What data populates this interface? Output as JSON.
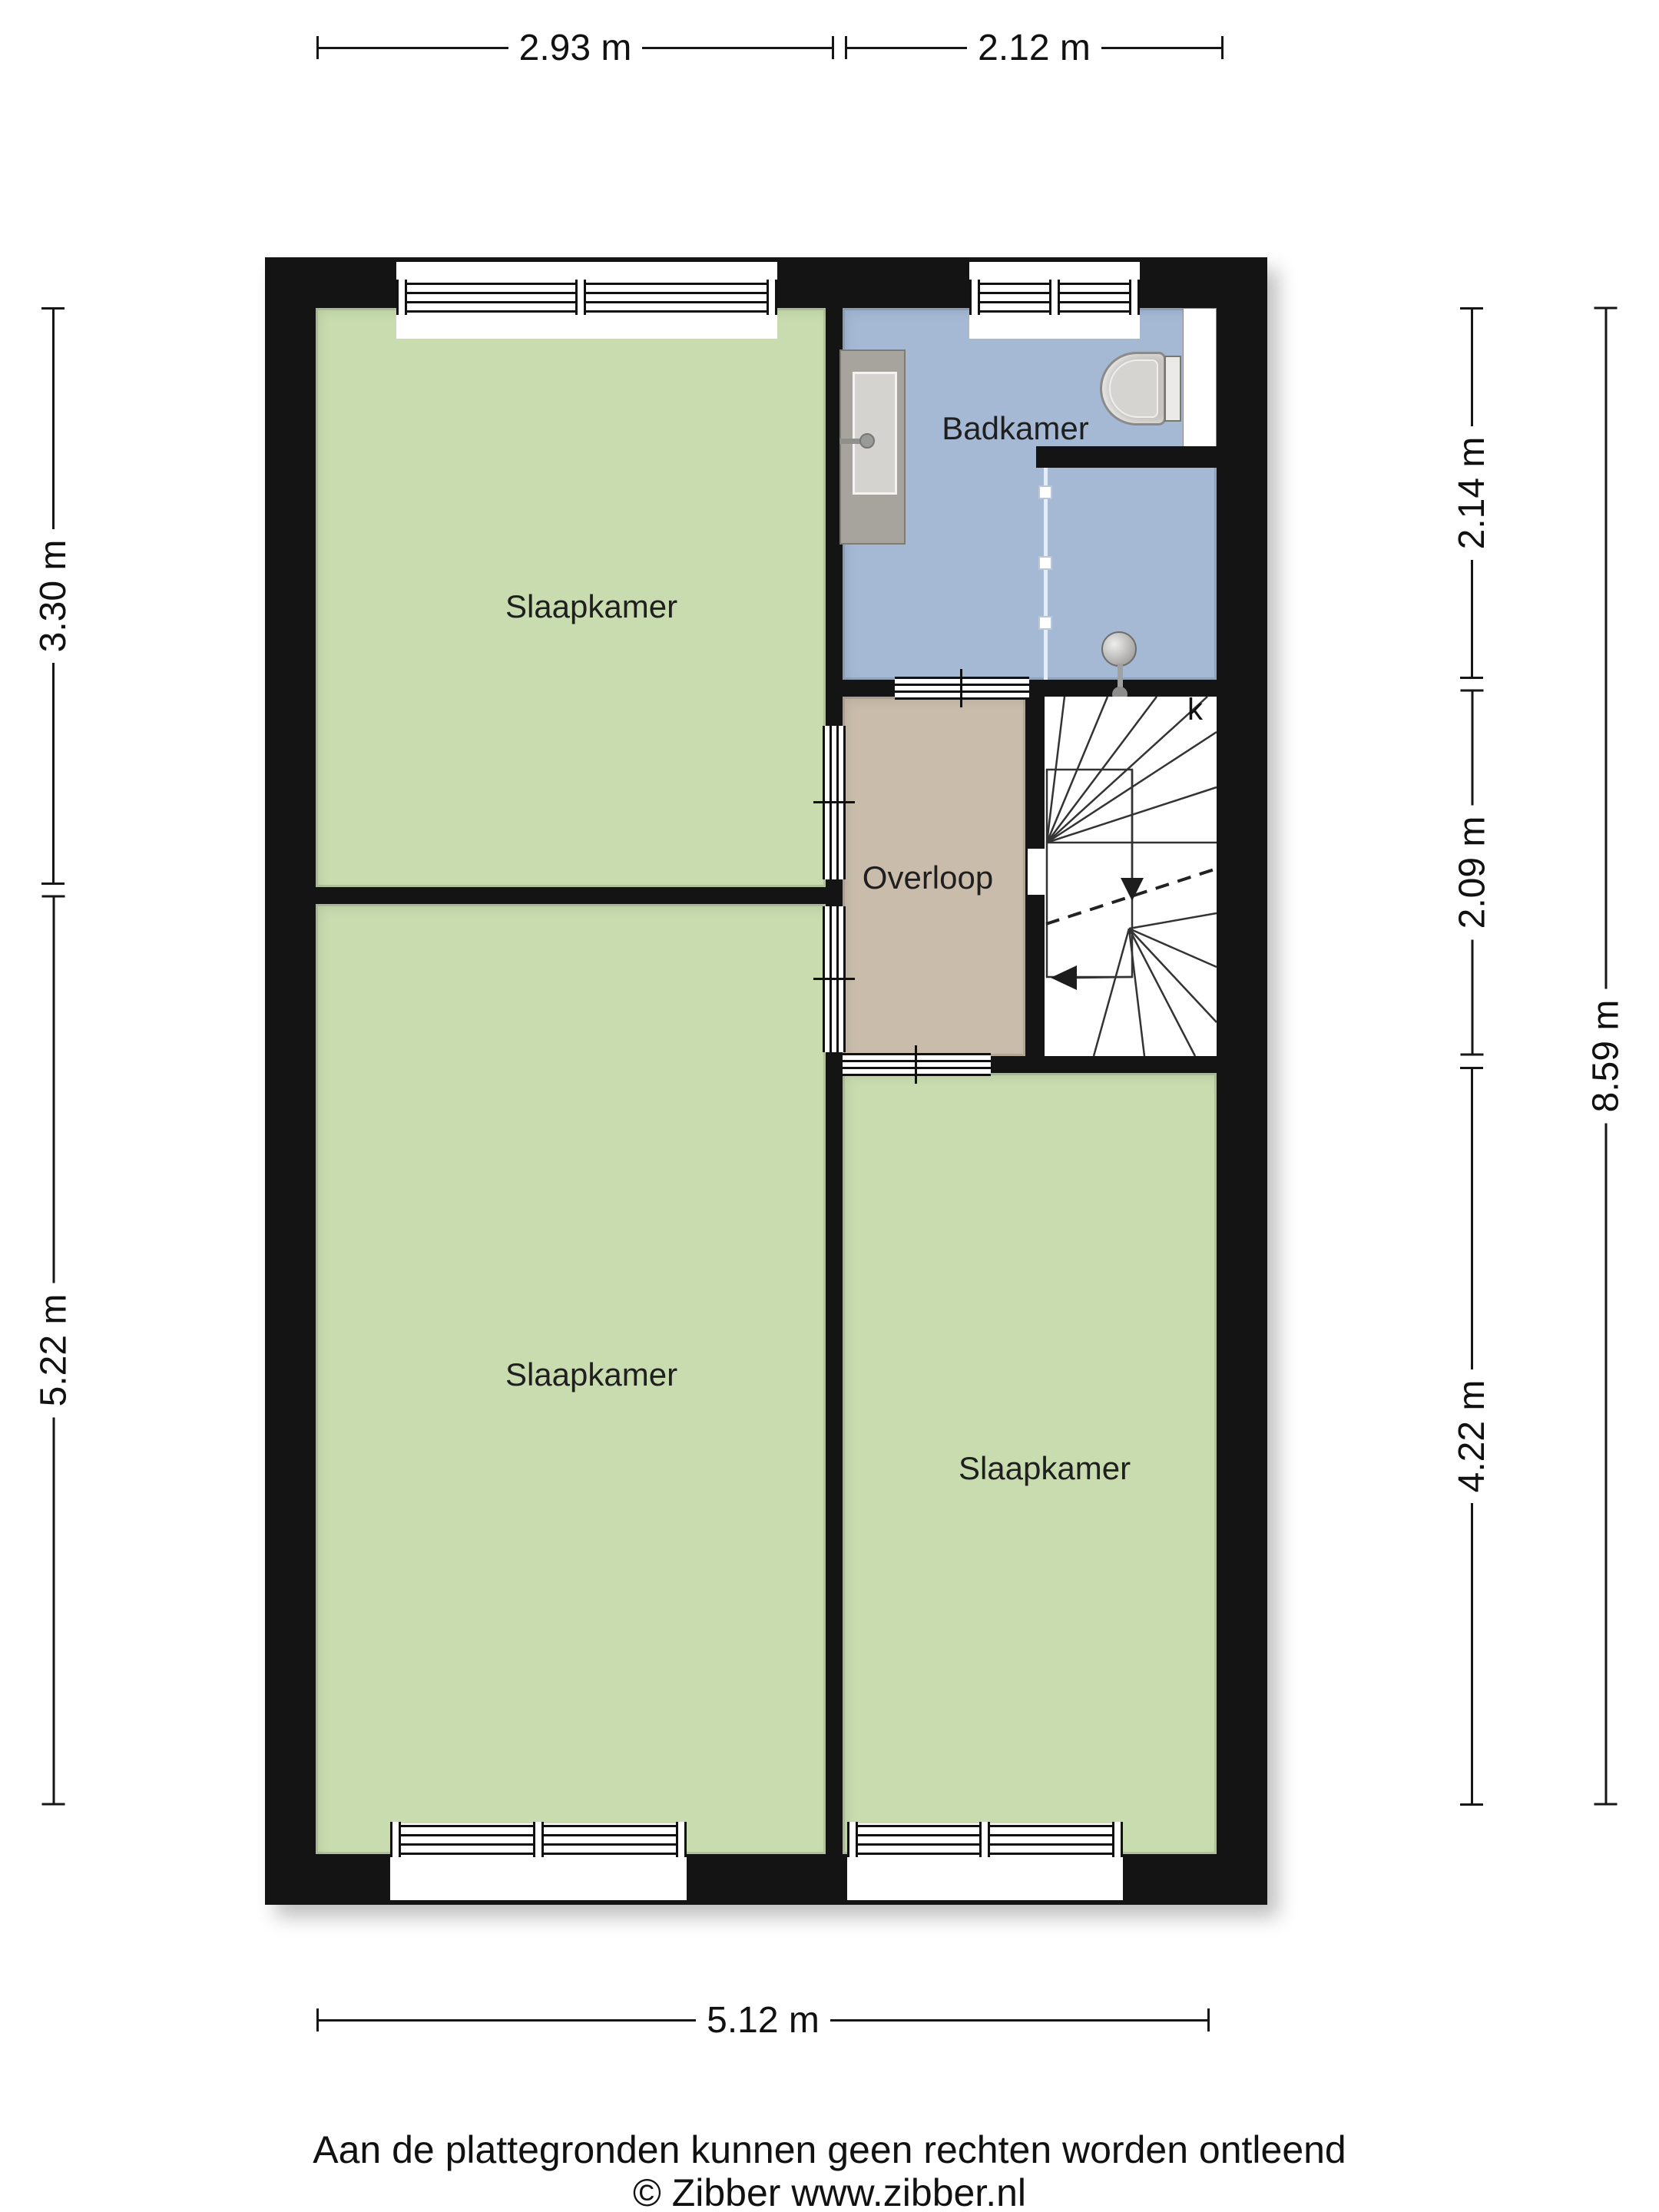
{
  "rooms": {
    "bedroom_top_left": {
      "label": "Slaapkamer"
    },
    "bedroom_bottom_left": {
      "label": "Slaapkamer"
    },
    "bedroom_bottom_right": {
      "label": "Slaapkamer"
    },
    "bathroom": {
      "label": "Badkamer"
    },
    "landing": {
      "label": "Overloop"
    },
    "stairs_closet": {
      "label": "k"
    }
  },
  "dimensions": {
    "top": [
      "2.93 m",
      "2.12 m"
    ],
    "left": [
      "3.30 m",
      "5.22 m"
    ],
    "right_inner": [
      "2.14 m",
      "2.09 m",
      "4.22 m"
    ],
    "right_outer": [
      "8.59 m"
    ],
    "bottom": [
      "5.12 m"
    ]
  },
  "footer": {
    "disclaimer": "Aan de plattegronden kunnen geen rechten worden ontleend",
    "credit": "© Zibber www.zibber.nl"
  },
  "colors": {
    "wall": "#141414",
    "room_green": "#c9dcb0",
    "room_blue": "#a5b9d5",
    "room_tan": "#c9bcab",
    "fixture_gray": "#a7a49d",
    "page_bg": "#ffffff"
  }
}
